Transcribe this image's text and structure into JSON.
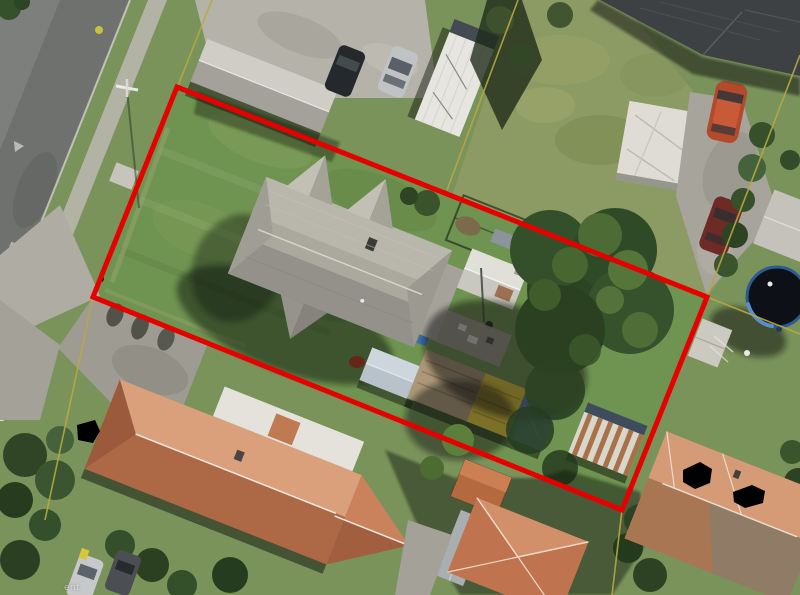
{
  "map": {
    "description": "Aerial photograph of suburban residential parcels with a cadastral boundary overlay; subject parcel outlined in red.",
    "watermark_fragment": "ent"
  },
  "overlay": {
    "parcel_color": "#e60000",
    "cadastral_color": "#b9a83f",
    "redaction_color": "#000000",
    "parcel_points": "177,87 707,297 622,510 93,297",
    "cadastral": {
      "north_extension": "212,0 177,88",
      "south_extension": "93,297 45,520",
      "northeast_extension": "800,55 707,297",
      "east_extension": "707,297 800,334",
      "southeast_extension": "622,510 612,595",
      "rear_boundary": "518,0 447,190"
    }
  },
  "scene": {
    "features": [
      "street with kerb and footpath (top-left)",
      "power pole on grass berm",
      "subject parcel lawn inside red outline",
      "subject house with grey hipped/gabled shingle roof and chimney",
      "white garden shed and fenced garden plot",
      "grey gabled shed behind house",
      "long garage with brown, yellow and blue roof sections",
      "rust-striped corrugated shed",
      "large dark green tree overhanging rear yard",
      "round trampoline with blue rim (right edge)",
      "north neighbour: long grey shed, black and silver parked cars, white outbuildings, dark-roofed house, red and maroon cars on driveway",
      "south-west neighbour: large terracotta roof house with white flat-roofed section and parked cars",
      "south neighbour: terracotta pyramid-roof house and grey shed",
      "south-east neighbour: terracotta roof house with black privacy redaction blobs",
      "driveways, hedges and shadow areas"
    ]
  }
}
